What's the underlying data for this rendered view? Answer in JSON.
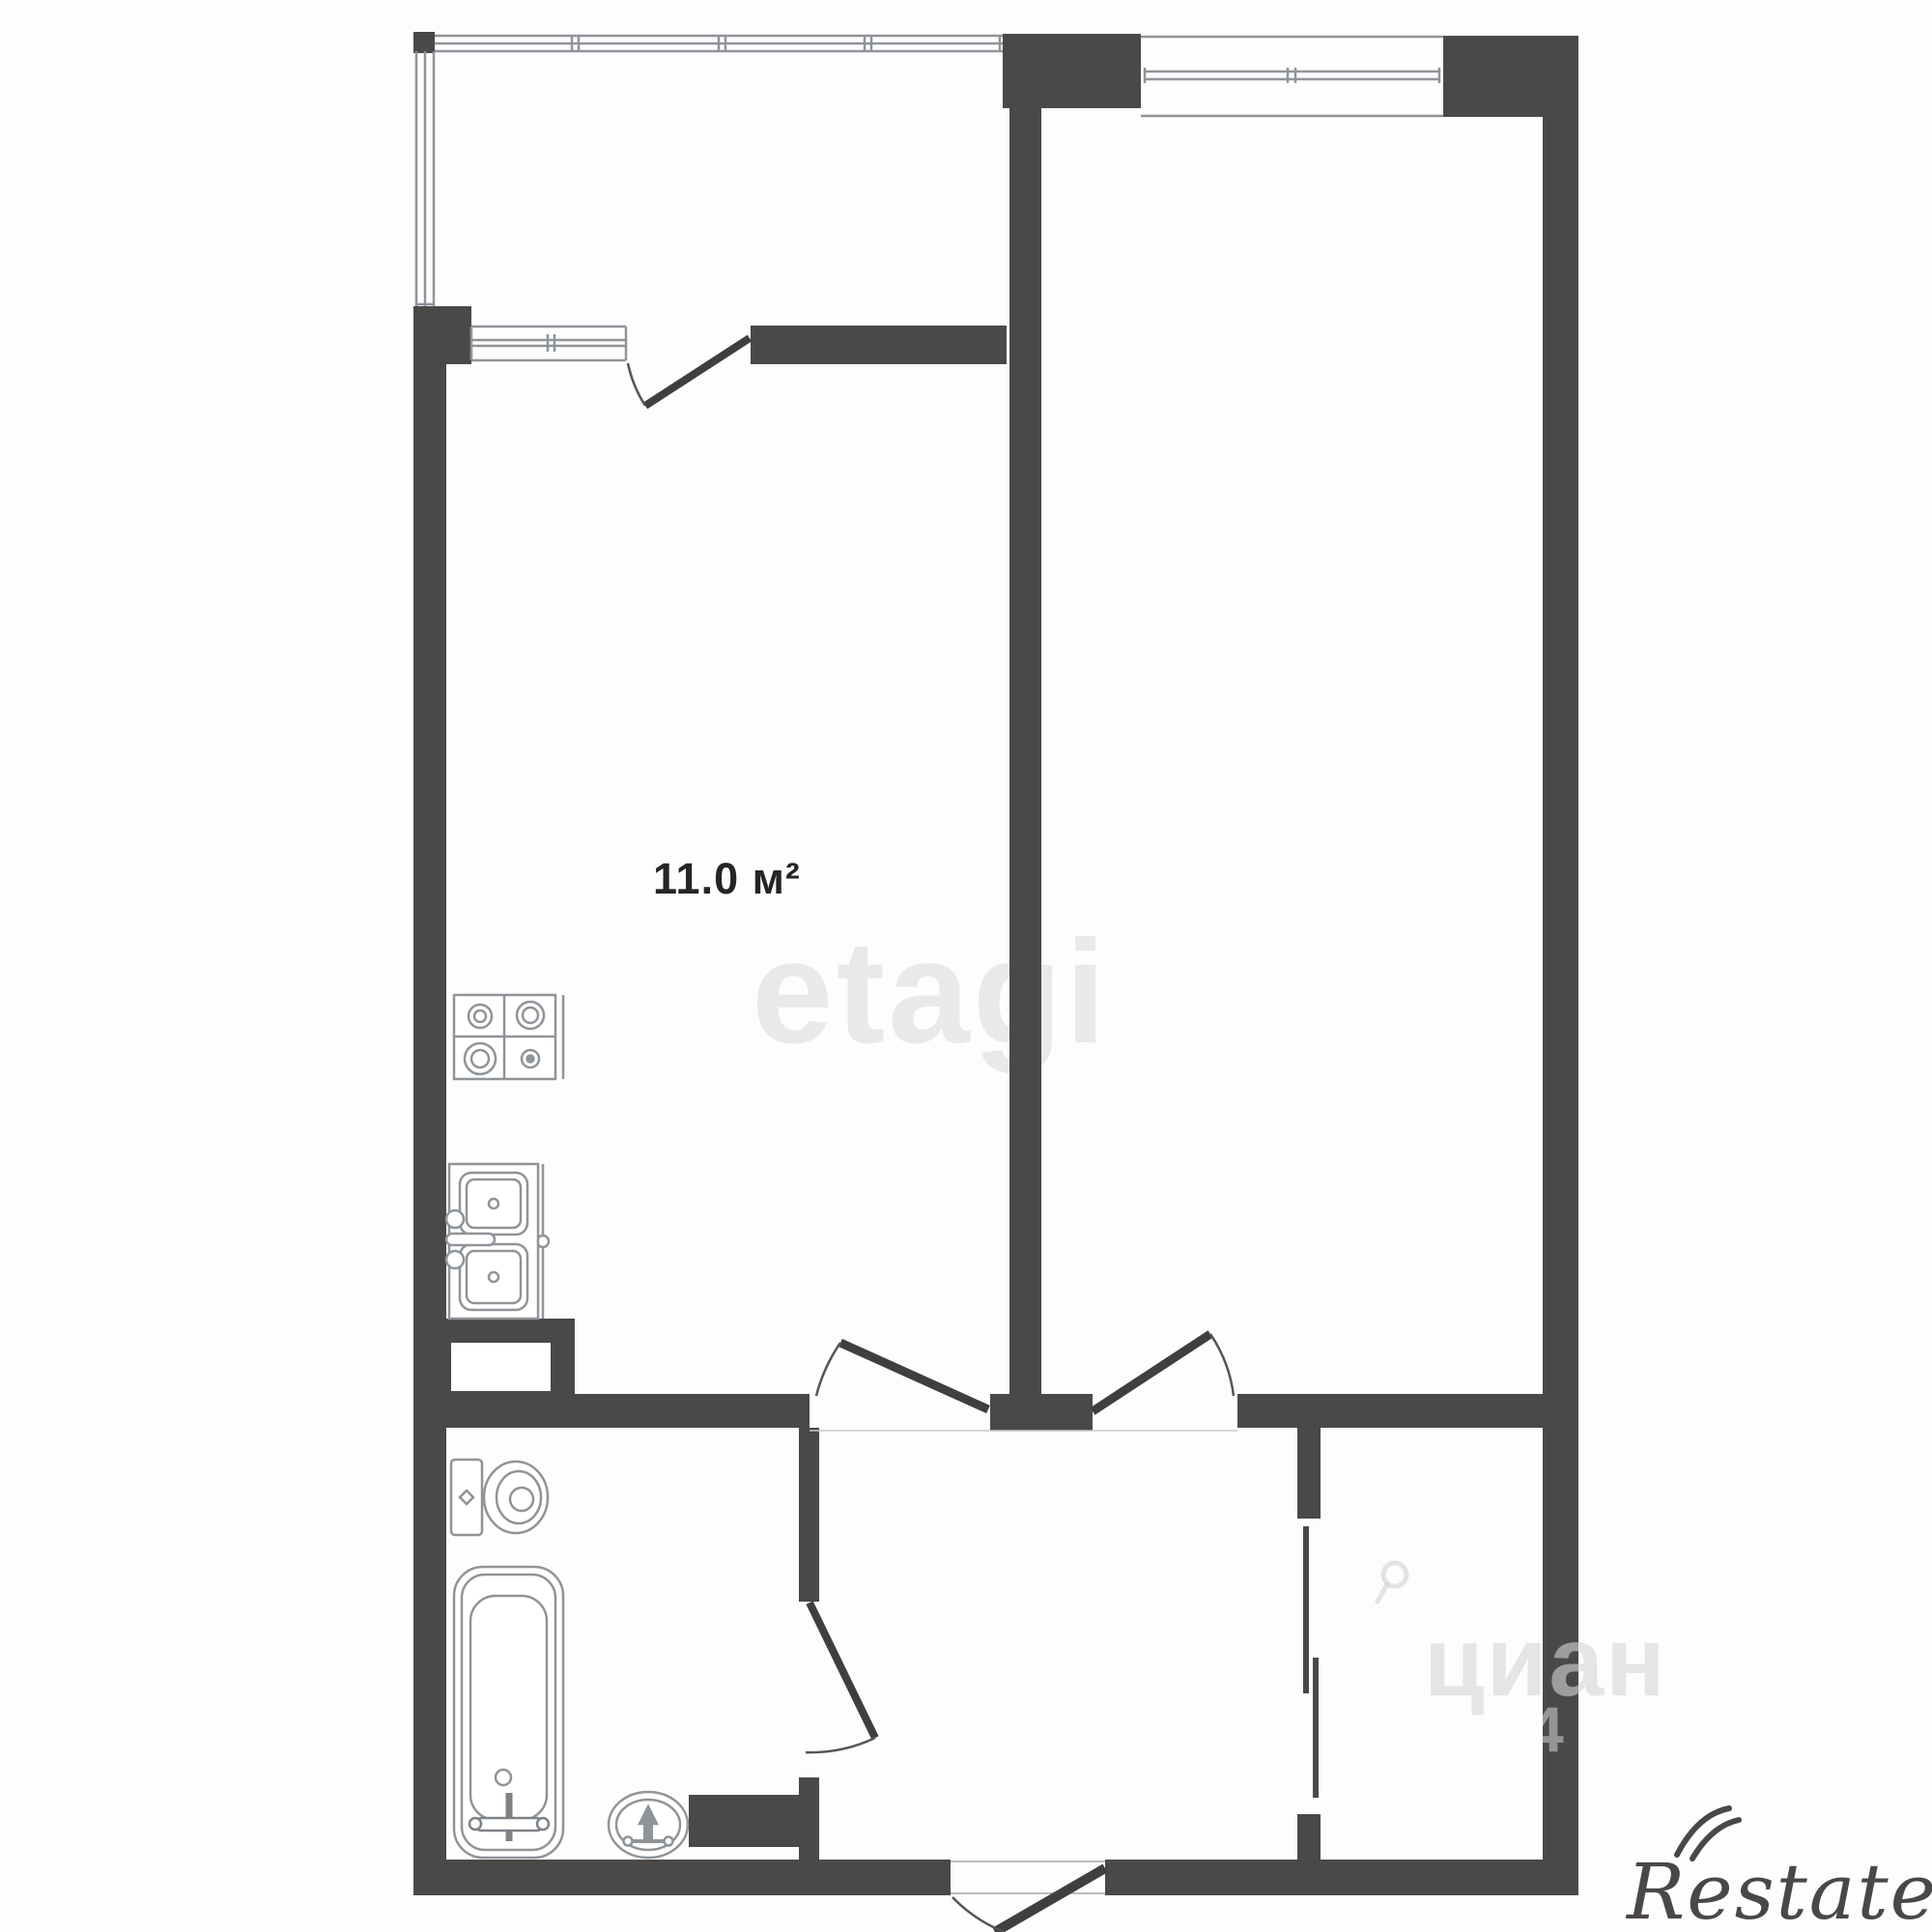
{
  "floor_plan": {
    "kitchen": {
      "area_label": "11.0 м²"
    },
    "watermarks": {
      "etagi": "etagi",
      "cian": "циан",
      "cian_number": "4",
      "restate": "Restate"
    },
    "colors": {
      "wall": "#4b4848",
      "fixture_line": "#8f9499",
      "door_leaf": "#413e3e",
      "background": "#fdfdfe",
      "etagi_watermark": "#e9e9ea",
      "restate_logo": "#4b4747"
    }
  }
}
